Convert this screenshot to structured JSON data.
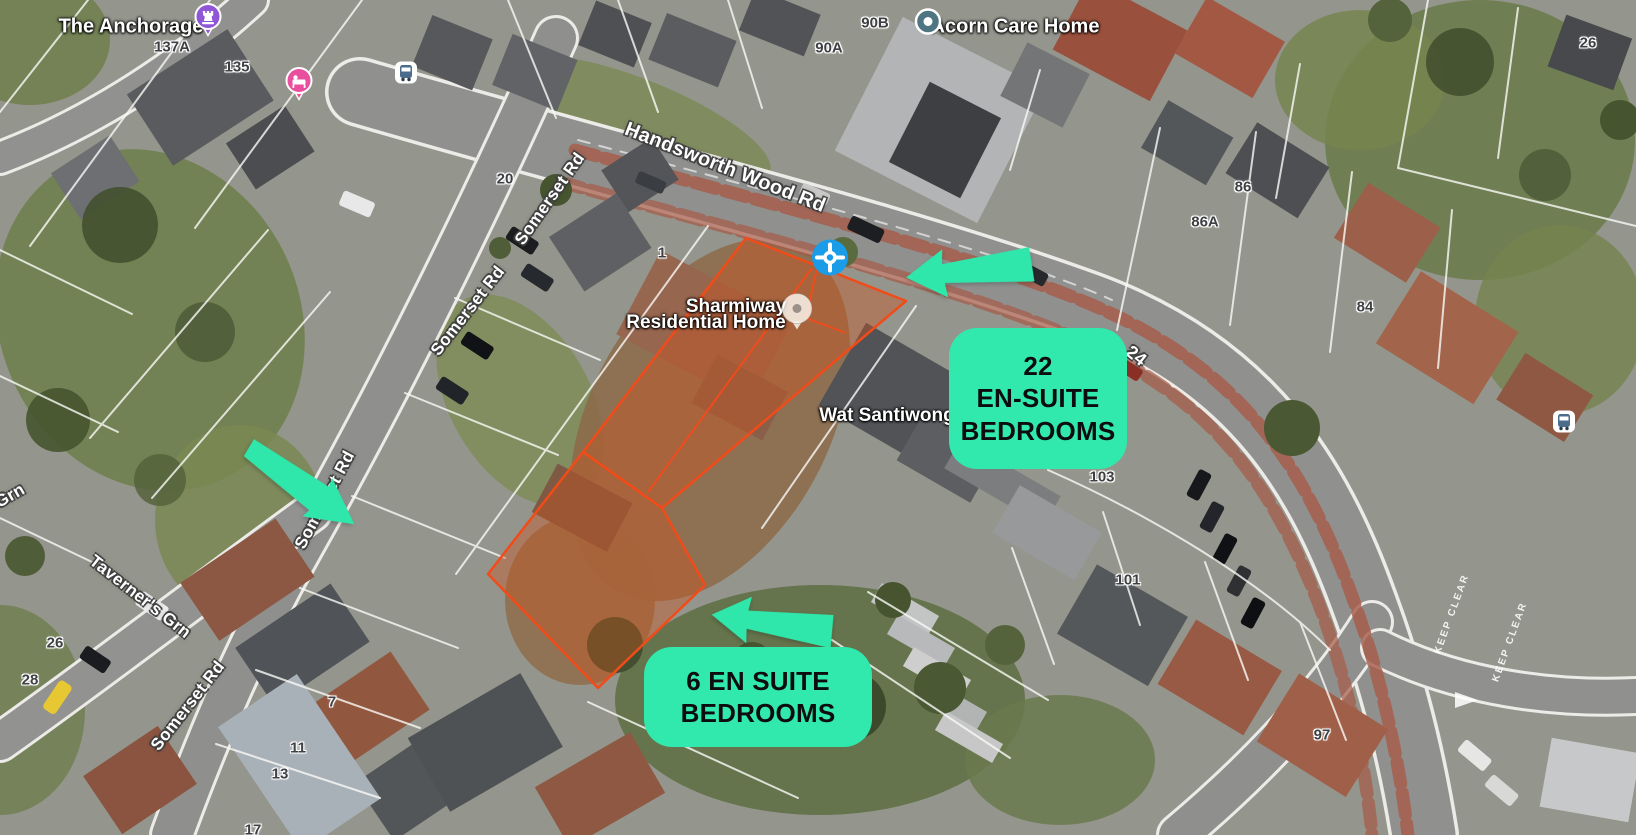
{
  "app": {
    "view": "satellite-map"
  },
  "map": {
    "roads": {
      "handsworth": "Handsworth Wood Rd",
      "somerset_1": "Somerset Rd",
      "somerset_2": "Somerset Rd",
      "somerset_3": "Somerset Rd",
      "somerset_4": "Somerset Rd",
      "taverners": "Taverner's Grn",
      "grn_partial": "Grn",
      "route_24": "24"
    },
    "places": {
      "anchorage": "The Anchorage",
      "acorn": "Acorn Care Home",
      "sharmiway_line1": "Sharmiway",
      "sharmiway_line2": "Residential Home",
      "wat": "Wat Santiwong"
    },
    "house_numbers": {
      "n137a": "137A",
      "n135": "135",
      "n20": "20",
      "n1": "1",
      "n90b": "90B",
      "n90a": "90A",
      "n86": "86",
      "n86a": "86A",
      "n84": "84",
      "n26_tr": "26",
      "n103": "103",
      "n101": "101",
      "n97": "97",
      "n26_bl": "26",
      "n28": "28",
      "n7": "7",
      "n11": "11",
      "n13": "13",
      "n17": "17"
    },
    "road_markings": {
      "keep_clear_1": "KEEP CLEAR",
      "keep_clear_2": "KEEP CLEAR"
    }
  },
  "annotations": {
    "badge_22": {
      "line1": "22",
      "line2": "EN-SUITE",
      "line3": "BEDROOMS"
    },
    "badge_6": {
      "line1": "6 EN SUITE",
      "line2": "BEDROOMS"
    },
    "colors": {
      "badge_bg": "#31E9AD",
      "badge_text": "#0D0D0D",
      "arrow": "#2FE7AA",
      "highlight_stroke": "#F24B1A",
      "highlight_fill": "rgba(207,82,26,0.38)",
      "marker_blue": "#1A9CE8"
    }
  }
}
